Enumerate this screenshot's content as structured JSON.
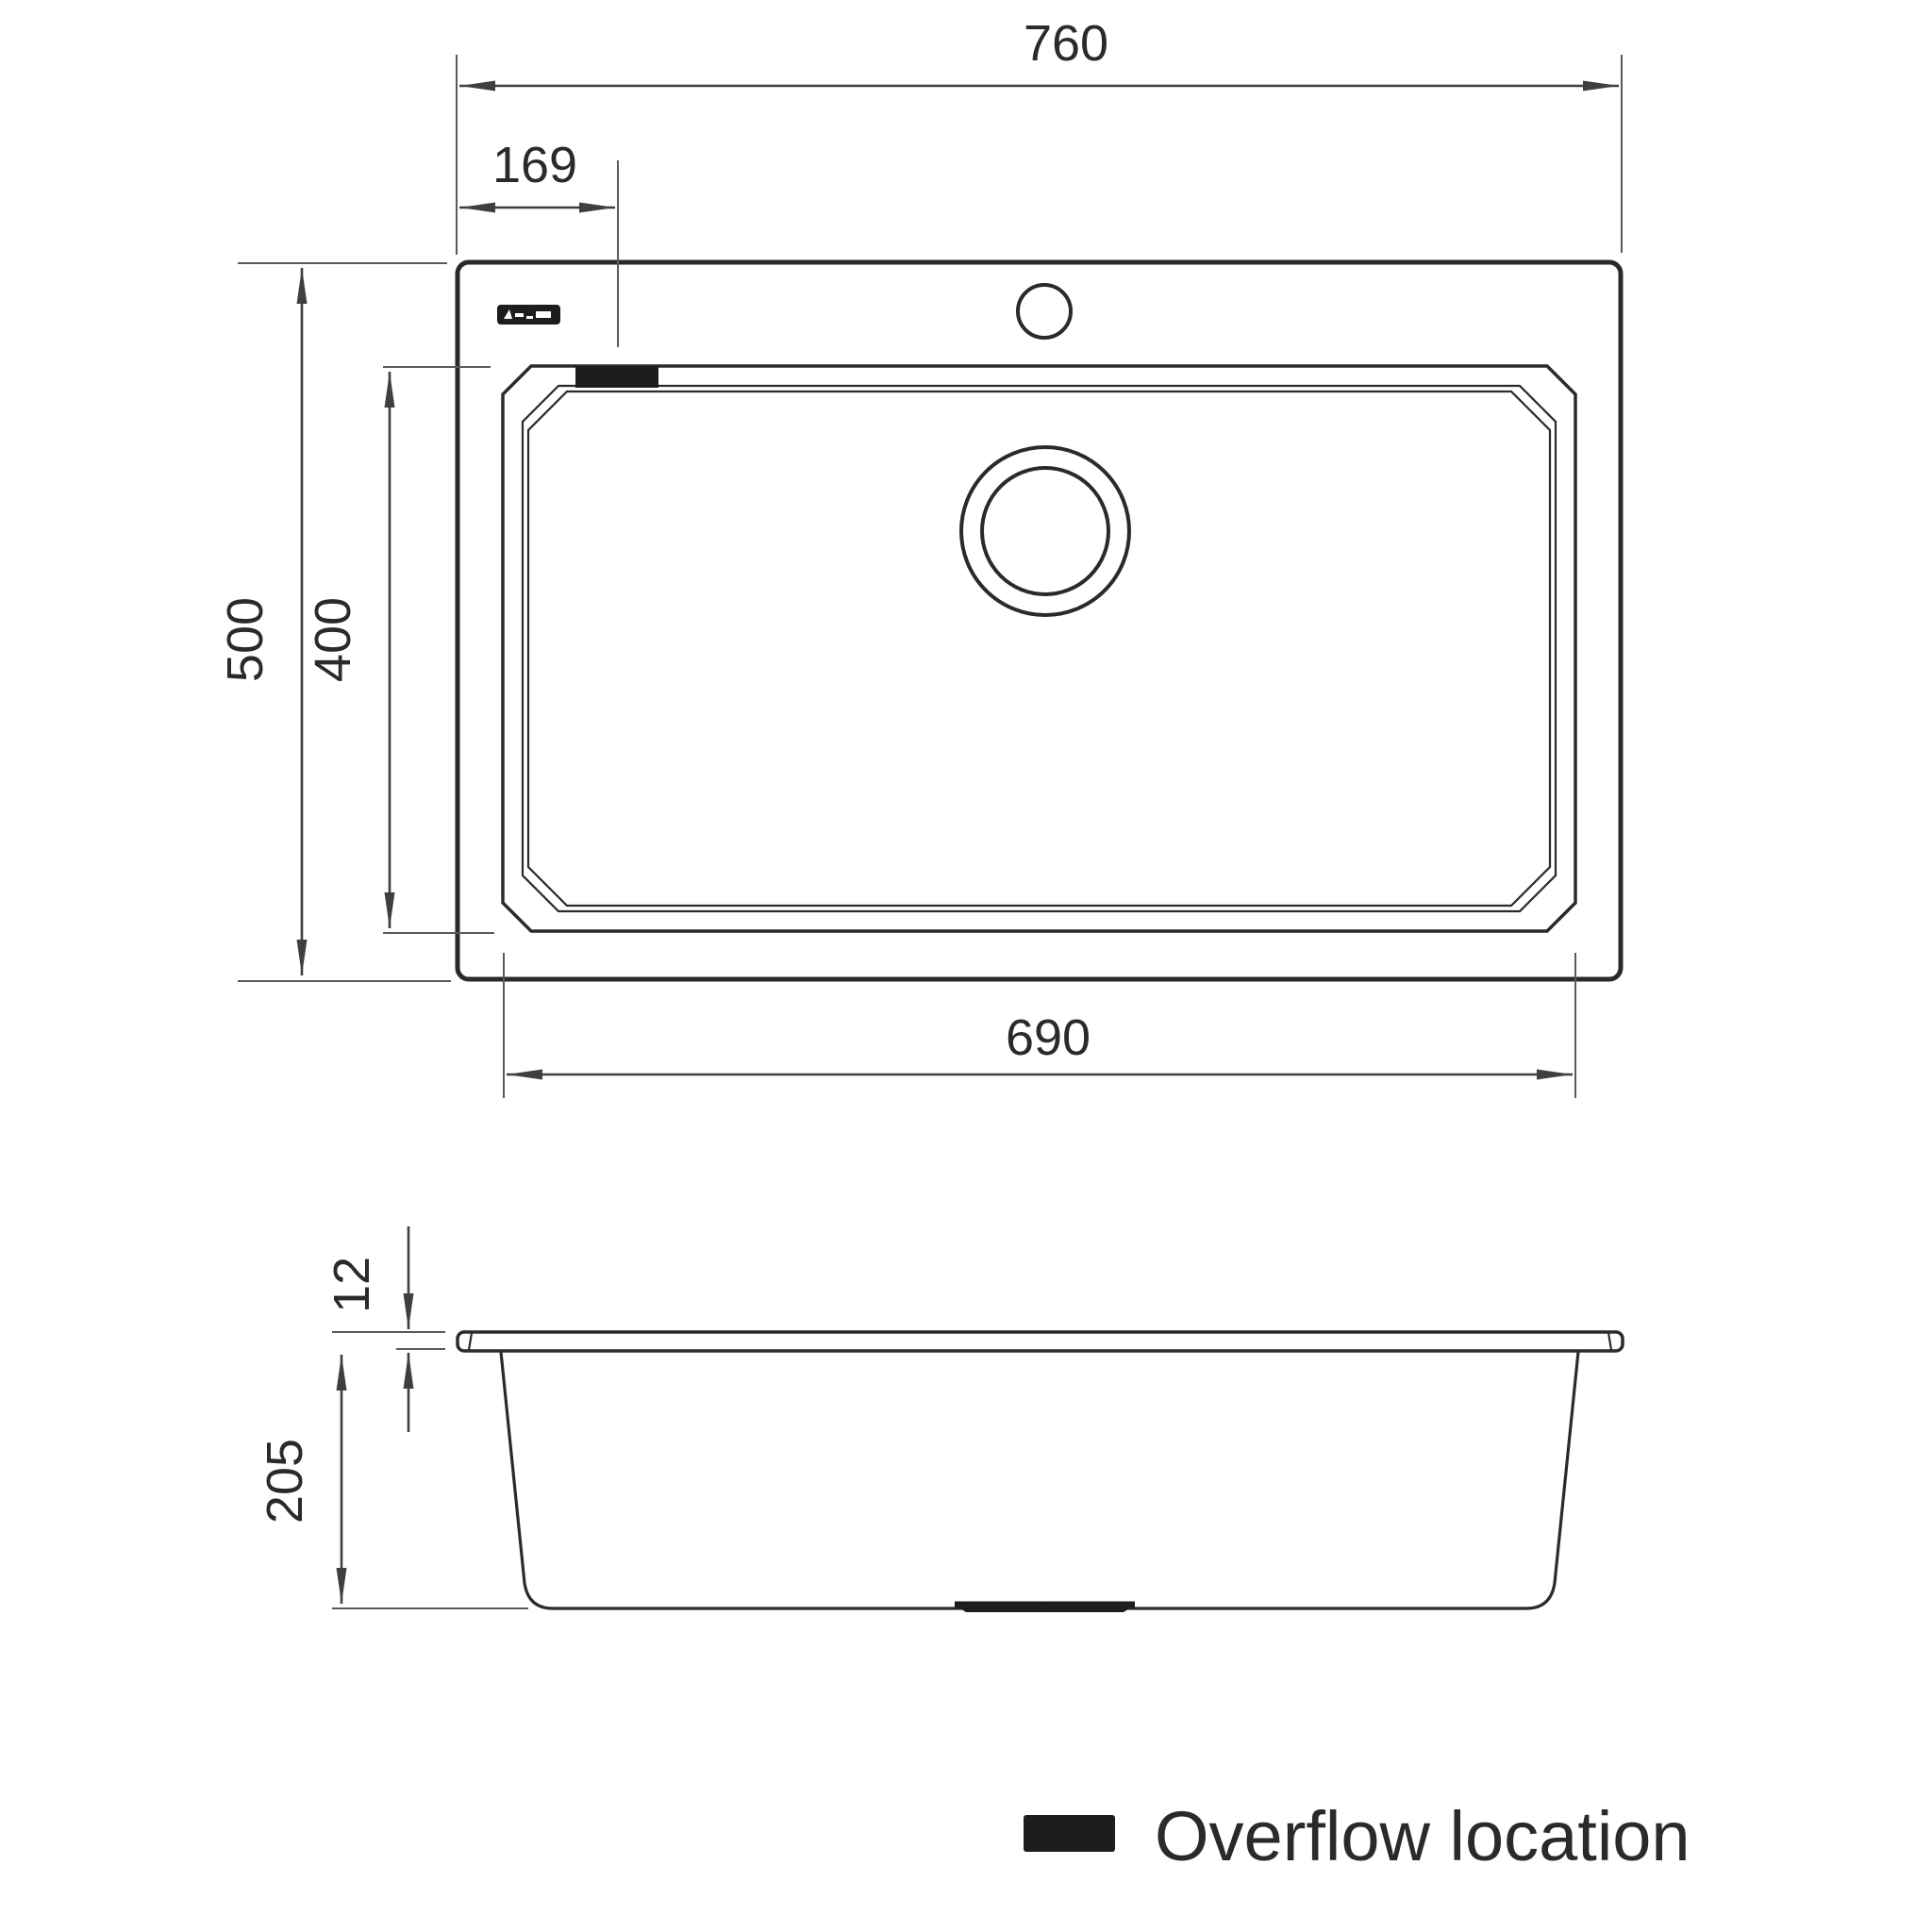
{
  "diagram": {
    "top_view": {
      "overall_width_label": "760",
      "overall_depth_label": "500",
      "overflow_offset_label": "169",
      "bowl_depth_label": "400",
      "bowl_width_label": "690"
    },
    "side_view": {
      "rim_thickness_label": "12",
      "bowl_height_label": "205"
    },
    "legend": {
      "label": "Overflow location"
    },
    "colors": {
      "line": "#2b2a28",
      "dimension_line": "#3f3f3f",
      "marker_fill": "#1d1d1b",
      "background": "#ffffff"
    }
  }
}
